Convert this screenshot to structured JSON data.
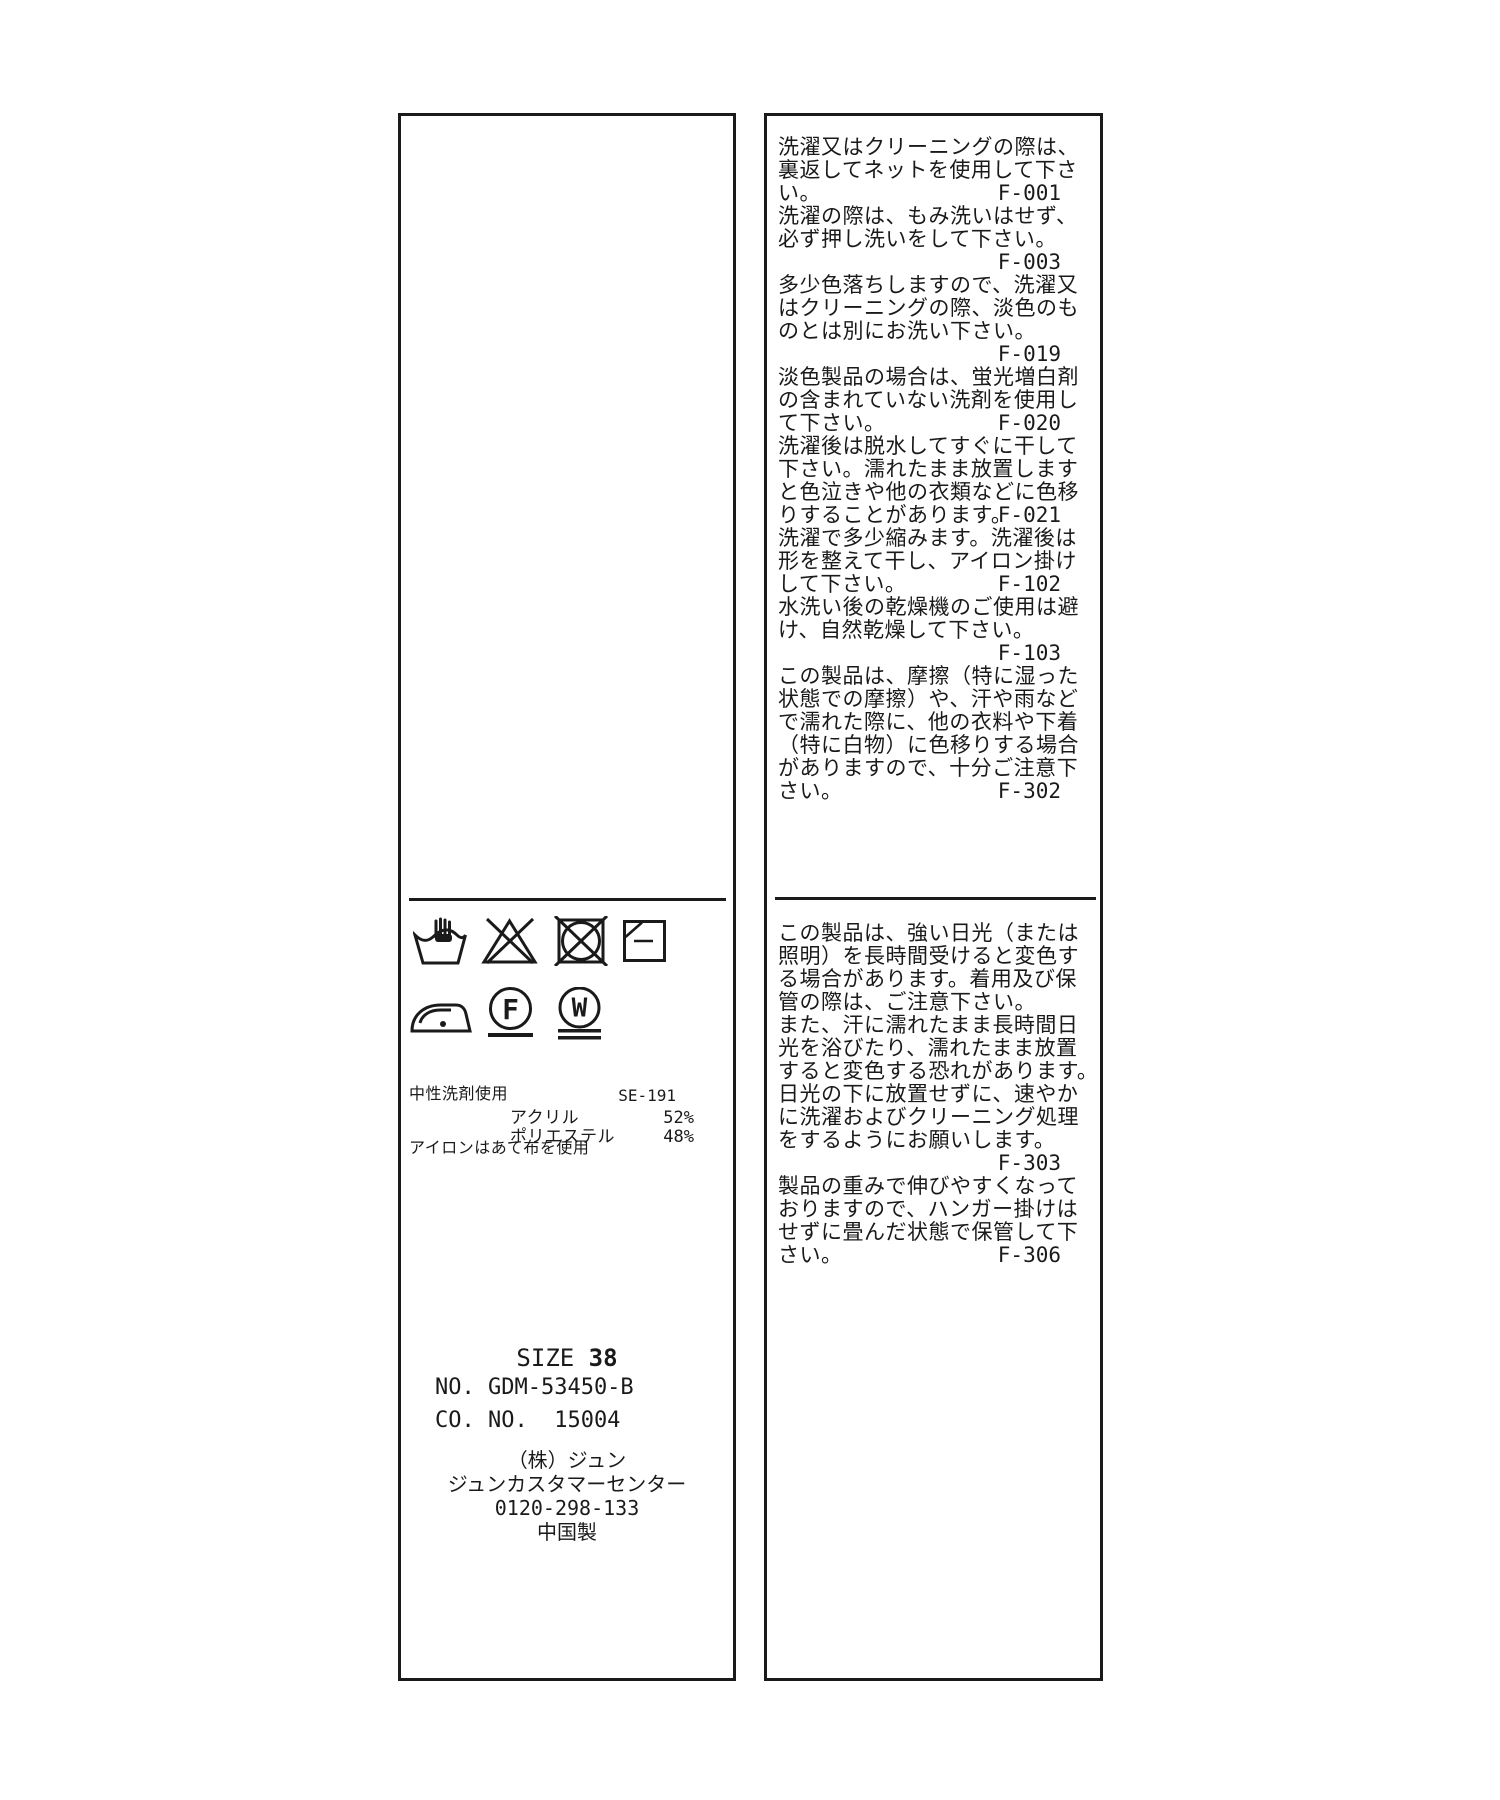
{
  "care_label": {
    "colors": {
      "ink": "#1a1a1a",
      "background": "#ffffff"
    },
    "left_panel": {
      "care_symbols": [
        {
          "name": "hand-wash-icon"
        },
        {
          "name": "do-not-bleach-icon"
        },
        {
          "name": "do-not-tumble-dry-icon"
        },
        {
          "name": "flat-dry-in-shade-icon"
        },
        {
          "name": "iron-low-heat-icon"
        },
        {
          "name": "dry-clean-petroleum-gentle-icon"
        },
        {
          "name": "wet-clean-very-gentle-icon"
        }
      ],
      "dry_clean_letter": "F",
      "wet_clean_letter": "W",
      "annotations": [
        "中性洗剤使用",
        "アイロンはあて布を使用"
      ],
      "quality_tag_code": "SE-191",
      "composition": [
        {
          "material": "アクリル",
          "percent": "52%"
        },
        {
          "material": "ポリエステル",
          "percent": "48%"
        }
      ],
      "size_label": "SIZE ",
      "size_value": "38",
      "item_no": "NO. GDM-53450-B",
      "co_no": "CO. NO.  15004",
      "company_lines": [
        "（株）ジュン",
        "ジュンカスタマーセンター",
        "0120-298-133",
        "中国製"
      ],
      "company_line_names": [
        "maker-name",
        "customer-center-name",
        "phone-number",
        "country-of-origin"
      ]
    },
    "right_panel": {
      "sections": [
        {
          "lines": [
            {
              "text": "洗濯又はクリーニングの際は、"
            },
            {
              "text": "裏返してネットを使用して下さ"
            },
            {
              "text": "い。",
              "code": "F-001"
            },
            {
              "text": "洗濯の際は、もみ洗いはせず、"
            },
            {
              "text": "必ず押し洗いをして下さい。"
            },
            {
              "text": "",
              "code": "F-003"
            },
            {
              "text": "多少色落ちしますので、洗濯又"
            },
            {
              "text": "はクリーニングの際、淡色のも"
            },
            {
              "text": "のとは別にお洗い下さい。"
            },
            {
              "text": "",
              "code": "F-019"
            },
            {
              "text": "淡色製品の場合は、蛍光増白剤"
            },
            {
              "text": "の含まれていない洗剤を使用し"
            },
            {
              "text": "て下さい。",
              "code": "F-020"
            },
            {
              "text": "洗濯後は脱水してすぐに干して"
            },
            {
              "text": "下さい。濡れたまま放置します"
            },
            {
              "text": "と色泣きや他の衣類などに色移"
            },
            {
              "text": "りすることがあります。",
              "code": "F-021"
            },
            {
              "text": "洗濯で多少縮みます。洗濯後は"
            },
            {
              "text": "形を整えて干し、アイロン掛け"
            },
            {
              "text": "して下さい。",
              "code": "F-102"
            },
            {
              "text": "水洗い後の乾燥機のご使用は避"
            },
            {
              "text": "け、自然乾燥して下さい。"
            },
            {
              "text": "",
              "code": "F-103"
            },
            {
              "text": "この製品は、摩擦（特に湿った"
            },
            {
              "text": "状態での摩擦）や、汗や雨など"
            },
            {
              "text": "で濡れた際に、他の衣料や下着"
            },
            {
              "text": "（特に白物）に色移りする場合"
            },
            {
              "text": "がありますので、十分ご注意下"
            },
            {
              "text": "さい。",
              "code": "F-302"
            }
          ]
        },
        {
          "lines": [
            {
              "text": "この製品は、強い日光（または"
            },
            {
              "text": "照明）を長時間受けると変色す"
            },
            {
              "text": "る場合があります。着用及び保"
            },
            {
              "text": "管の際は、ご注意下さい。"
            },
            {
              "text": "また、汗に濡れたまま長時間日"
            },
            {
              "text": "光を浴びたり、濡れたまま放置"
            },
            {
              "text": "すると変色する恐れがあります。"
            },
            {
              "text": "日光の下に放置せずに、速やか"
            },
            {
              "text": "に洗濯およびクリーニング処理"
            },
            {
              "text": "をするようにお願いします。"
            },
            {
              "text": "",
              "code": "F-303"
            },
            {
              "text": "製品の重みで伸びやすくなって"
            },
            {
              "text": "おりますので、ハンガー掛けは"
            },
            {
              "text": "せずに畳んだ状態で保管して下"
            },
            {
              "text": "さい。",
              "code": "F-306"
            }
          ]
        }
      ]
    }
  }
}
